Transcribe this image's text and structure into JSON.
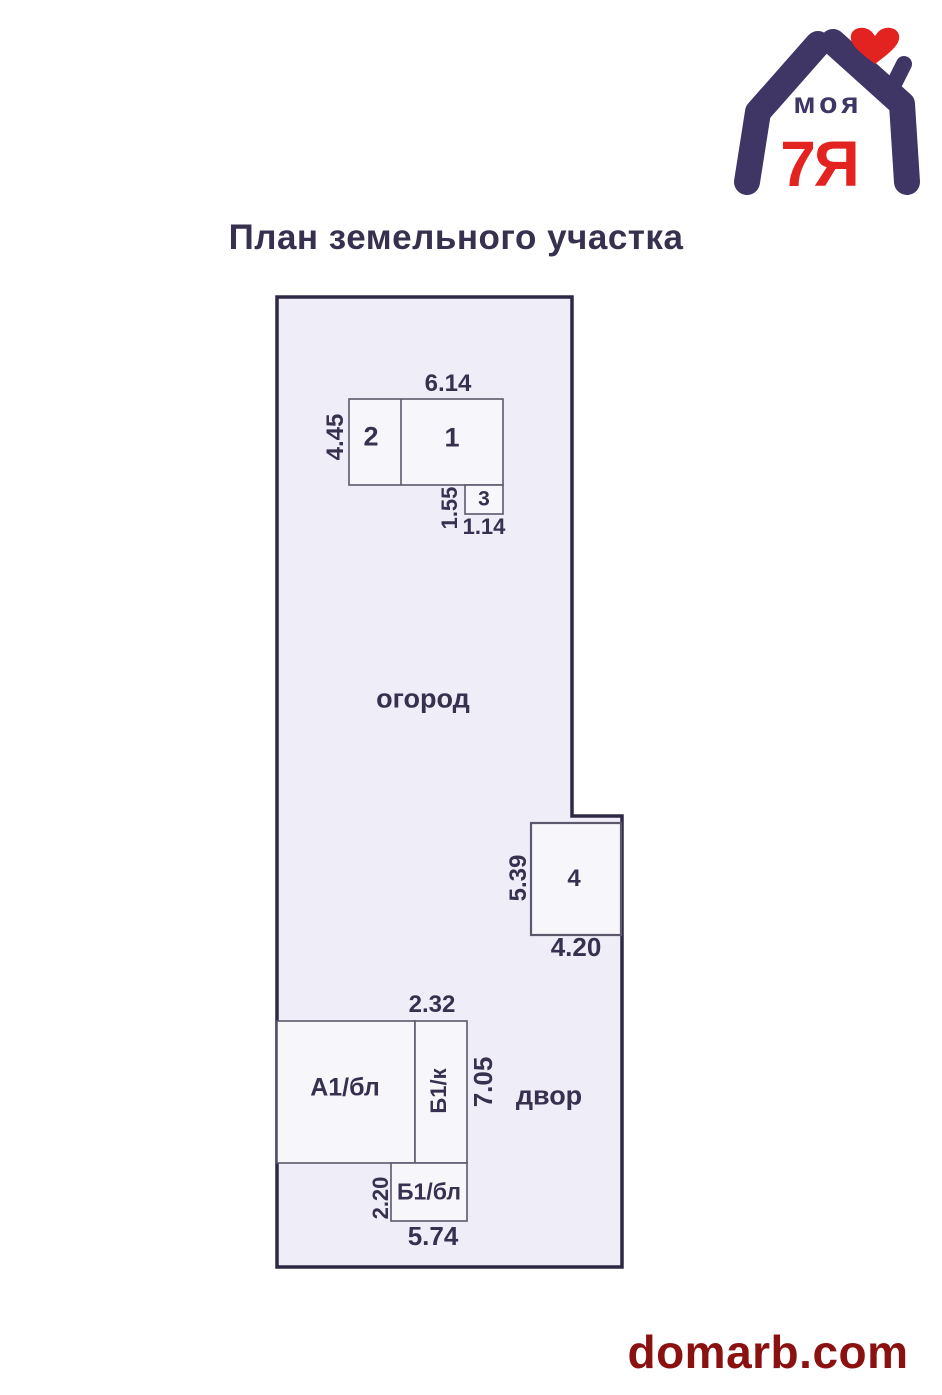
{
  "title": "План земельного участка",
  "logo": {
    "brand_top": "моя",
    "brand_bottom": "7Я",
    "navy": "#3f3666",
    "red": "#e2231f"
  },
  "plan": {
    "areas": {
      "garden": "огород",
      "yard": "двор"
    },
    "buildings": {
      "b1": "1",
      "b2": "2",
      "b3": "3",
      "b4": "4",
      "a1bl": "А1/бл",
      "b1k": "Б1/к",
      "b1bl": "Б1/бл"
    },
    "dimensions": {
      "d614": "6.14",
      "d445": "4.45",
      "d155": "1.55",
      "d114": "1.14",
      "d539": "5.39",
      "d420": "4.20",
      "d232": "2.32",
      "d705": "7.05",
      "d220": "2.20",
      "d574": "5.74"
    },
    "colors": {
      "label_navy": "#37304e",
      "plot_border": "#2e2843",
      "plot_fill": "#efedf7",
      "building_fill": "#f7f6fb",
      "building_stroke": "#5d586b",
      "watermark_red": "#8b1010"
    }
  },
  "watermark": "domarb.com"
}
